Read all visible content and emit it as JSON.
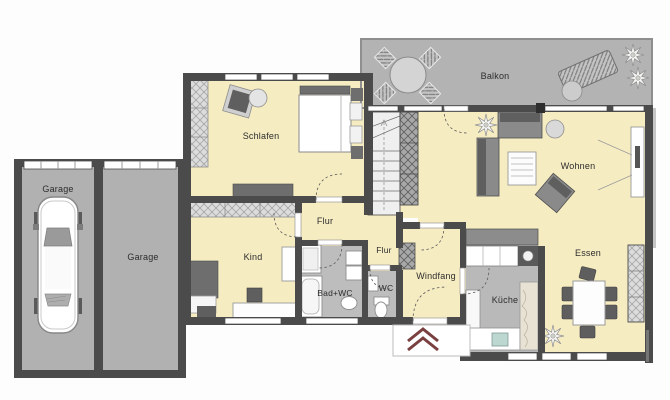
{
  "rooms": [
    {
      "id": "garage-left",
      "label": "Garage"
    },
    {
      "id": "garage-right",
      "label": "Garage"
    },
    {
      "id": "schlafen",
      "label": "Schlafen"
    },
    {
      "id": "balkon",
      "label": "Balkon"
    },
    {
      "id": "wohnen",
      "label": "Wohnen"
    },
    {
      "id": "flur-upper",
      "label": "Flur"
    },
    {
      "id": "flur-lower",
      "label": "Flur"
    },
    {
      "id": "kind",
      "label": "Kind"
    },
    {
      "id": "bad",
      "label": "Bad+WC"
    },
    {
      "id": "wc",
      "label": "WC"
    },
    {
      "id": "windfang",
      "label": "Windfang"
    },
    {
      "id": "kueche",
      "label": "Küche"
    },
    {
      "id": "essen",
      "label": "Essen"
    }
  ],
  "entrance": {
    "marker": "double-chevron-up"
  },
  "colors": {
    "wall": "#4b4b4b",
    "living_floor": "#f6ecc2",
    "wet_floor": "#bdbdbd",
    "outdoor_floor": "#b3b3b3",
    "entrance_arrow": "#7a4040",
    "label_text": "#2d2d2d"
  }
}
